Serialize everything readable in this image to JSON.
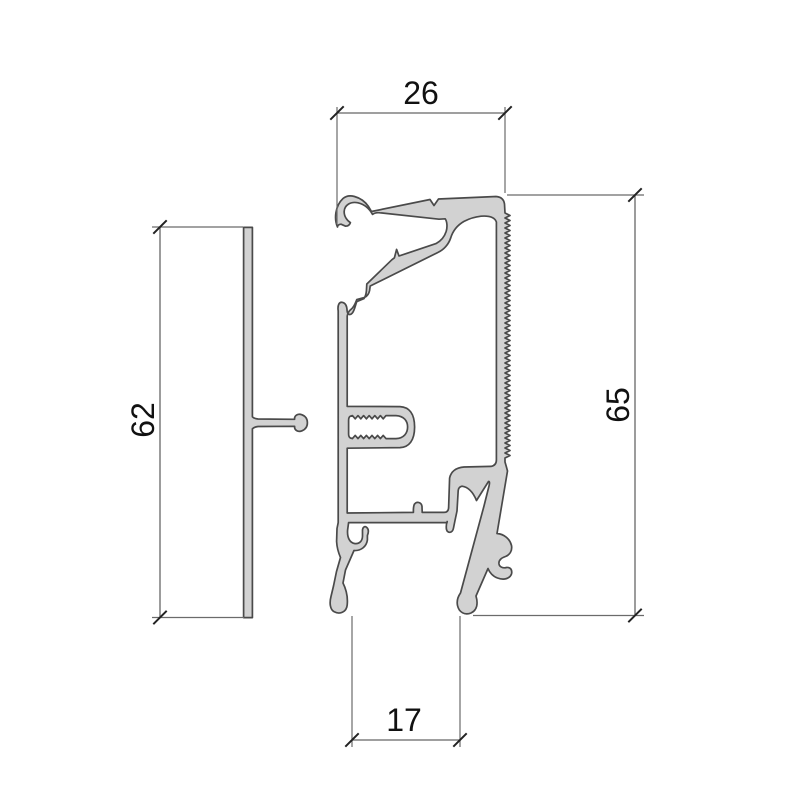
{
  "drawing": {
    "type": "technical-drawing",
    "subject": "aluminium-extrusion-profile-cross-section",
    "colors": {
      "background": "#ffffff",
      "profile_fill": "#d2d2d2",
      "profile_stroke": "#4a4a4a",
      "dimension_line": "#666666",
      "tick": "#222222",
      "text": "#111111"
    },
    "dimensions": {
      "top_width": "26",
      "right_height": "65",
      "left_height": "62",
      "bottom_gap": "17"
    }
  }
}
